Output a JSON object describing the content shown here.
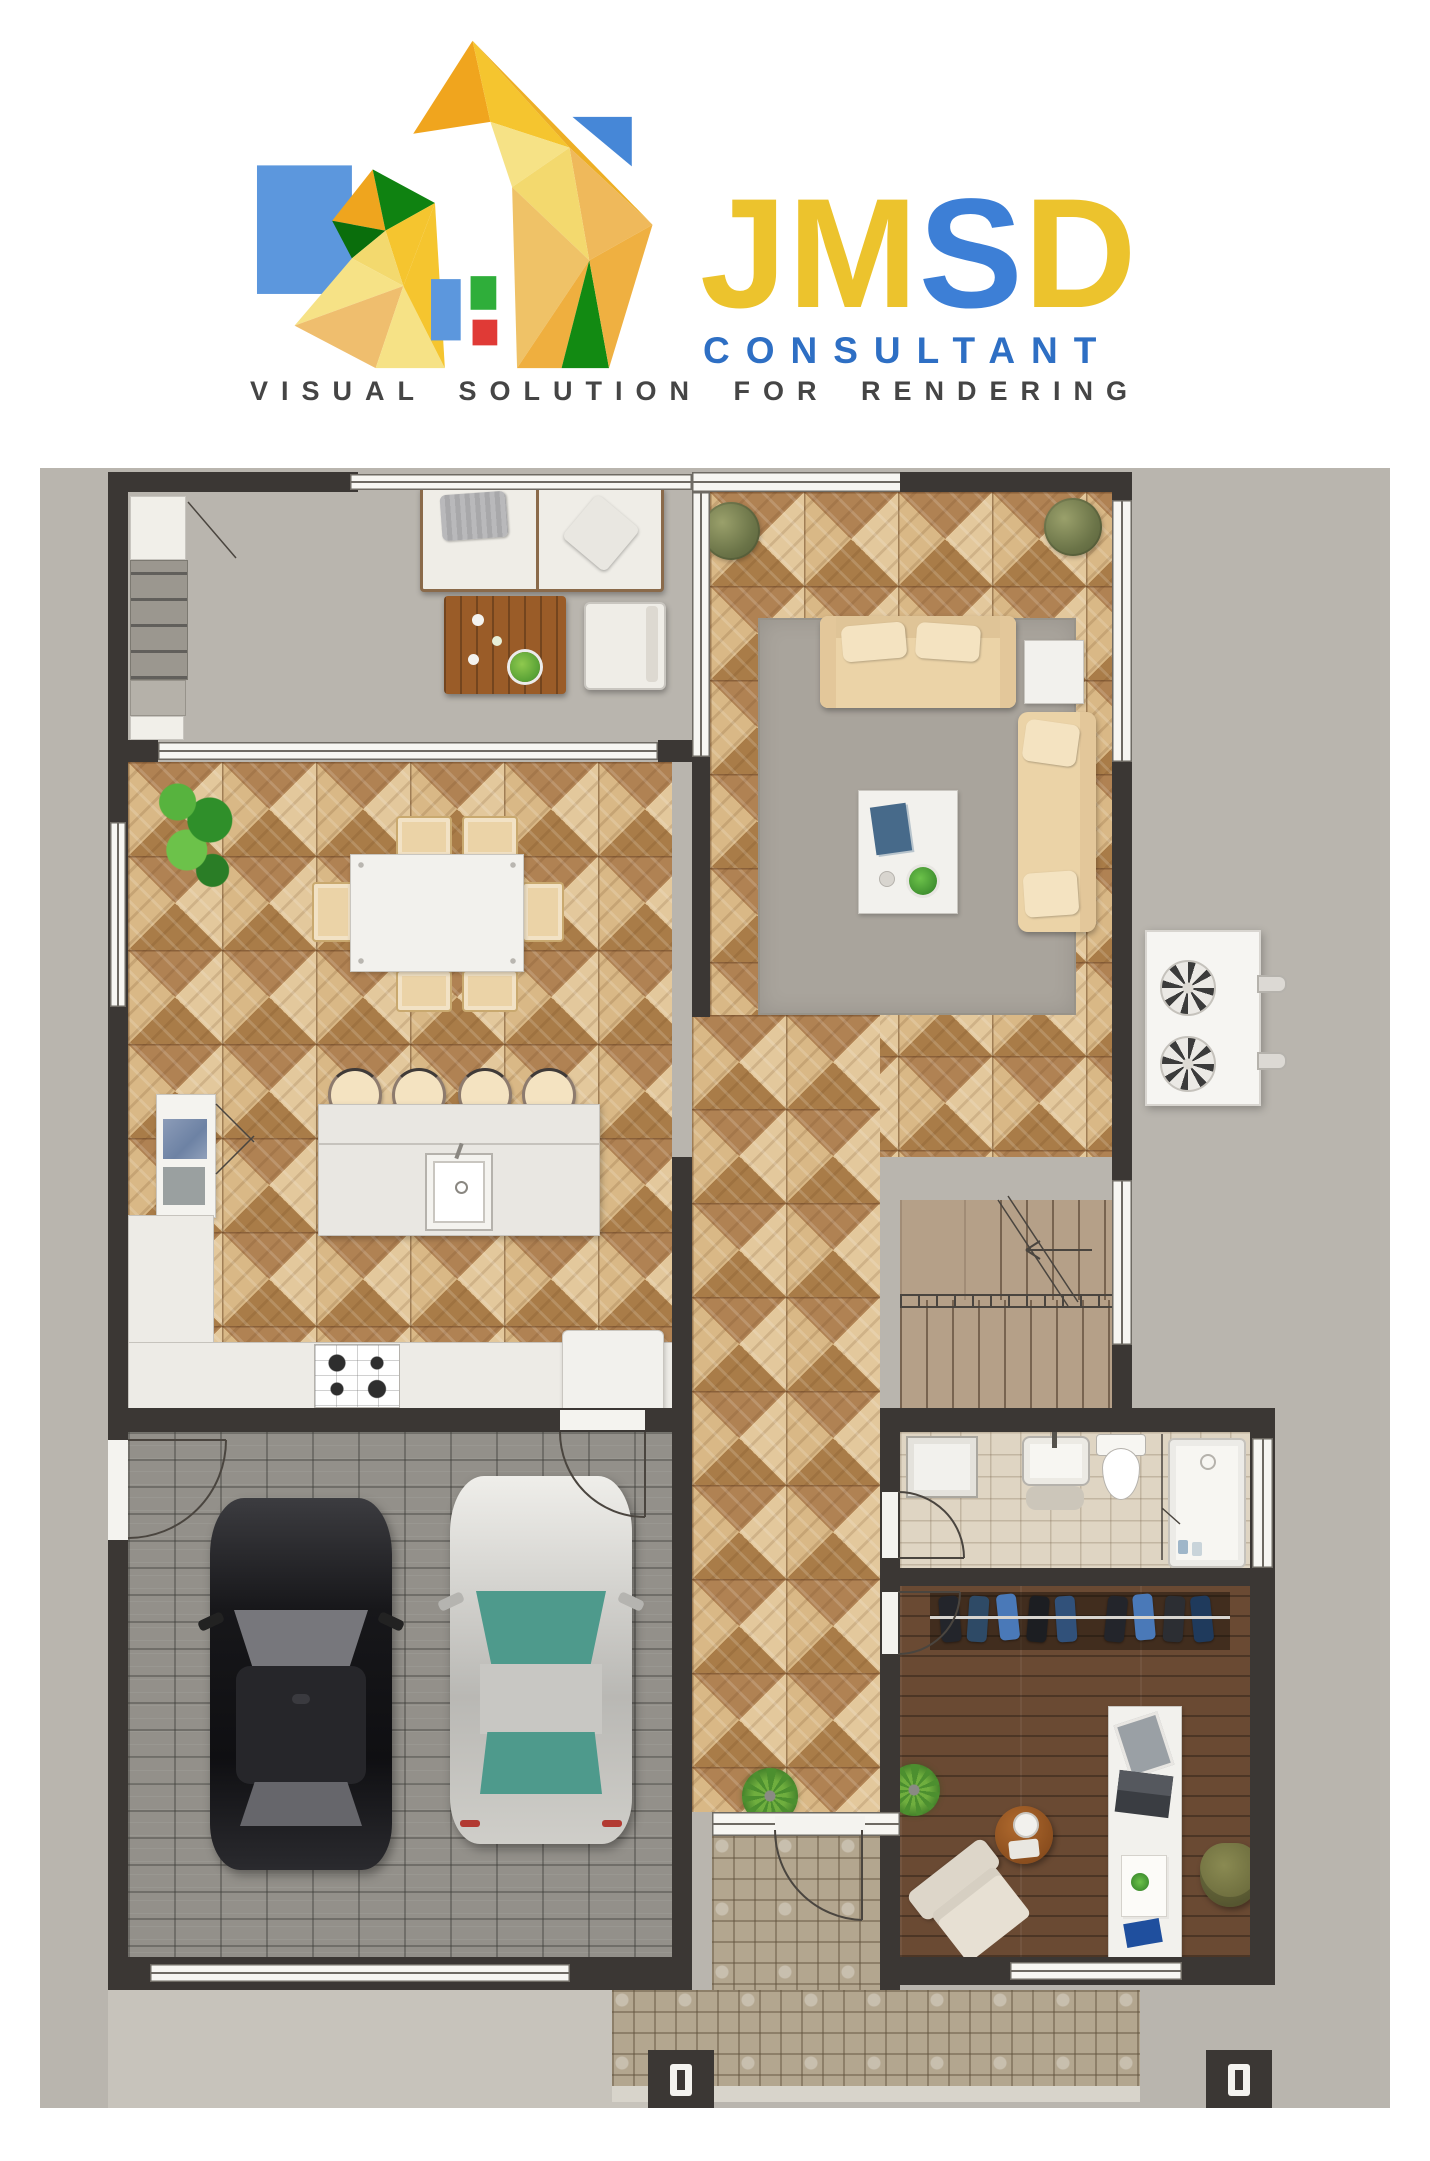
{
  "logo": {
    "brand": [
      {
        "char": "J",
        "color": "#ECC32D"
      },
      {
        "char": "M",
        "color": "#ECC32D"
      },
      {
        "char": "S",
        "color": "#3D7FD6"
      },
      {
        "char": "D",
        "color": "#ECC32D"
      }
    ],
    "subtitle": "CONSULTANT",
    "tagline_words": [
      "VISUAL",
      "SOLUTION",
      "FOR",
      "RENDERING"
    ]
  },
  "palette": {
    "brand_yellow": "#ECC32D",
    "brand_blue": "#3D7FD6",
    "subtitle_blue": "#2E6FC4",
    "tagline_gray": "#454545",
    "wall": "#3B3734",
    "canvas": "#B9B5AE",
    "parquet": "#C49A66",
    "parquet_dark": "#A97C48",
    "parquet_light": "#E3C89C",
    "garage_floor": "#93908A",
    "driveway": "#C7C3BB",
    "porch_tile": "#B3A68F",
    "bath_tile": "#DFD5C3",
    "wood_floor": "#6A4A33",
    "stair_wood": "#B5A088",
    "rug": "#A9A49C",
    "sofa_beige": "#EBD3A7",
    "pillow_beige": "#F4E3C1",
    "white_furniture": "#F2F1ED",
    "counter": "#EDEBE6",
    "island": "#E9E7E2",
    "plant_green": "#3E8F35",
    "shrub_green": "#7D8455",
    "car_black": "#1E1E20",
    "car_silver": "#D6D5D1",
    "car_glass_teal": "#4E9A8C",
    "closet_cloth_blue": "#3A6EA8",
    "office_chair_olive": "#6F6F3D",
    "table_wood": "#9A5C28",
    "accent_red": "#D93025",
    "logo_green": "#128A12"
  },
  "plan": {
    "areas": [
      "patio",
      "living-room",
      "dining-area",
      "kitchen",
      "garage",
      "hallway",
      "stairs",
      "bathroom",
      "walk-in-closet",
      "home-office",
      "entry-porch",
      "driveway"
    ],
    "objects": [
      "outdoor-sofa",
      "outdoor-coffee-table",
      "outdoor-chair",
      "outdoor-console",
      "living-sofa",
      "chaise-lounge",
      "coffee-table",
      "area-rug",
      "side-table",
      "corner-plants",
      "dining-table",
      "dining-chairs",
      "large-plant",
      "kitchen-island",
      "bar-stools",
      "sink",
      "fridge",
      "cooktop",
      "counters",
      "ac-condenser-unit",
      "black-car",
      "silver-car",
      "staircase",
      "vanity-sink",
      "toilet",
      "shower",
      "storage-cabinet",
      "hanging-clothes",
      "desk",
      "office-chair",
      "lounge-chair",
      "round-side-table",
      "entry-ferns",
      "porch-pillars"
    ]
  }
}
